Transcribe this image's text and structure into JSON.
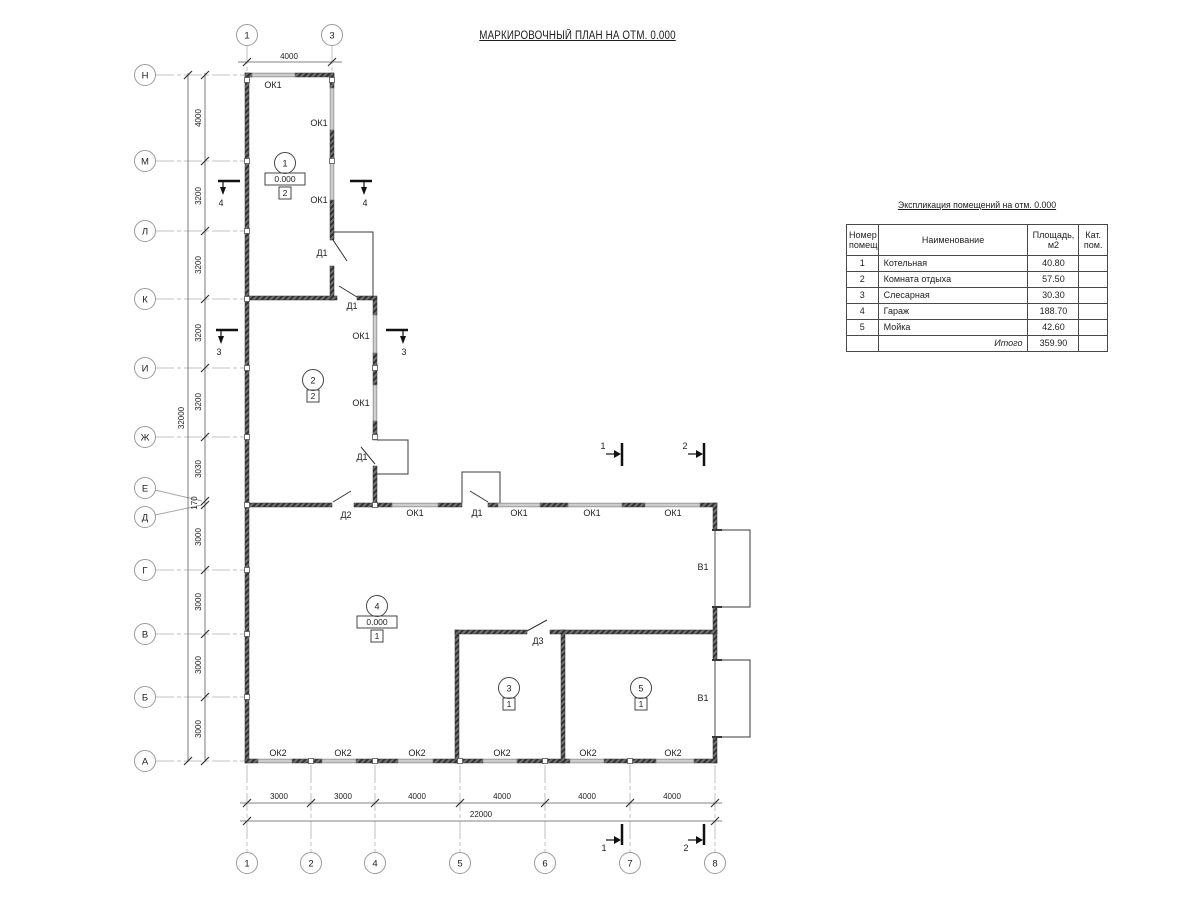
{
  "title": "МАРКИРОВОЧНЫЙ ПЛАН НА ОТМ. 0.000",
  "axes": {
    "top": [
      "1",
      "3"
    ],
    "bottom": [
      "1",
      "2",
      "4",
      "5",
      "6",
      "7",
      "8"
    ],
    "left": [
      "Н",
      "М",
      "Л",
      "К",
      "И",
      "Ж",
      "Е",
      "Д",
      "Г",
      "В",
      "Б",
      "А"
    ]
  },
  "dims": {
    "top": "4000",
    "left": [
      "4000",
      "3200",
      "3200",
      "3200",
      "3200",
      "3030",
      "170",
      "3000",
      "3000",
      "3000",
      "3000"
    ],
    "left_total": "32000",
    "bottom": [
      "3000",
      "3000",
      "4000",
      "4000",
      "4000",
      "4000"
    ],
    "bottom_total": "22000"
  },
  "marks": {
    "window1": "ОК1",
    "window2": "ОК2",
    "door1": "Д1",
    "door2": "Д2",
    "door3": "Д3",
    "gate1": "В1"
  },
  "sections": {
    "s1": "1",
    "s2": "2",
    "s3": "3",
    "s4": "4"
  },
  "rooms": {
    "r1": {
      "number": "1",
      "elevation": "0.000",
      "category": "2"
    },
    "r2": {
      "number": "2",
      "category": "2"
    },
    "r3": {
      "number": "3",
      "category": "1"
    },
    "r4": {
      "number": "4",
      "elevation": "0.000",
      "category": "1"
    },
    "r5": {
      "number": "5",
      "category": "1"
    }
  },
  "table": {
    "title": "Экспликация помещений на отм. 0.000",
    "headers": {
      "number": "Номер помещ.",
      "name": "Наименование",
      "area": "Площадь, м2",
      "cat": "Кат. пом."
    },
    "rows": [
      {
        "number": "1",
        "name": "Котельная",
        "area": "40.80"
      },
      {
        "number": "2",
        "name": "Комната отдыха",
        "area": "57.50"
      },
      {
        "number": "3",
        "name": "Слесарная",
        "area": "30.30"
      },
      {
        "number": "4",
        "name": "Гараж",
        "area": "188.70"
      },
      {
        "number": "5",
        "name": "Мойка",
        "area": "42.60"
      }
    ],
    "total_label": "Итого",
    "total_value": "359.90"
  }
}
